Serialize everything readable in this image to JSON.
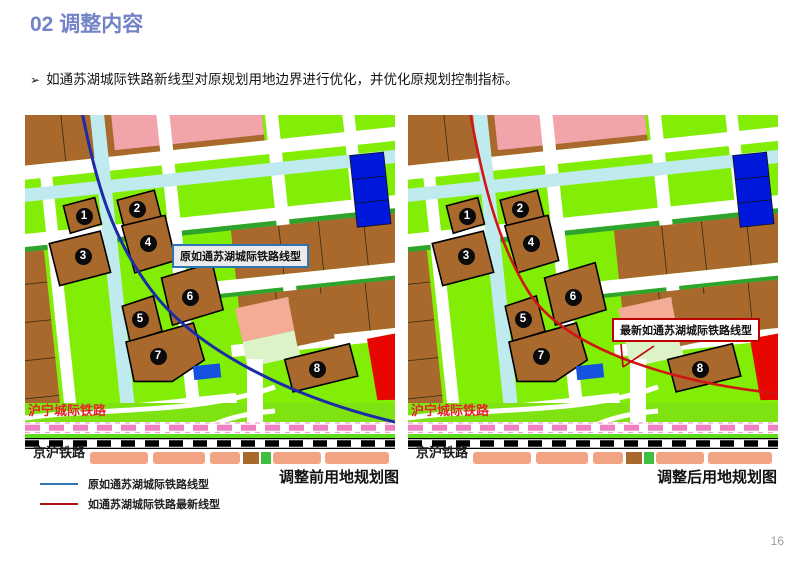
{
  "slide": {
    "title": "02 调整内容",
    "bullet_marker": "➢",
    "bullet": "如通苏湖城际铁路新线型对原规划用地边界进行优化，并优化原规划控制指标。",
    "page_number": "16"
  },
  "maps": {
    "left": {
      "caption": "调整前用地规划图",
      "annotation": "原如通苏湖城际铁路线型",
      "railway_intercity": "沪宁城际铁路",
      "railway_jinghu": "京沪铁路",
      "parcels": [
        "1",
        "2",
        "3",
        "4",
        "5",
        "6",
        "7",
        "8"
      ]
    },
    "right": {
      "caption": "调整后用地规划图",
      "annotation": "最新如通苏湖城际铁路线型",
      "railway_intercity": "沪宁城际铁路",
      "railway_jinghu": "京沪铁路",
      "parcels": [
        "1",
        "2",
        "3",
        "4",
        "5",
        "6",
        "7",
        "8"
      ]
    }
  },
  "legend": {
    "items": [
      {
        "label": "原如通苏湖城际铁路线型",
        "color": "#2E75B6"
      },
      {
        "label": "如通苏湖城际铁路最新线型",
        "color": "#B01116"
      }
    ]
  },
  "colors": {
    "title_accent": "#7283C8",
    "old_line": "#1B2CA6",
    "new_line": "#D11515",
    "parcel_brown": "#A9692C",
    "greenland": "#82EE05",
    "water_cyan": "#C0EBEE",
    "red_parcel": "#E80600",
    "blue_parcel": "#0018DC",
    "pink_parcel": "#F2A4AA",
    "salmon_parcel": "#F2A384",
    "railway_pink_dash": "#F080C4"
  }
}
